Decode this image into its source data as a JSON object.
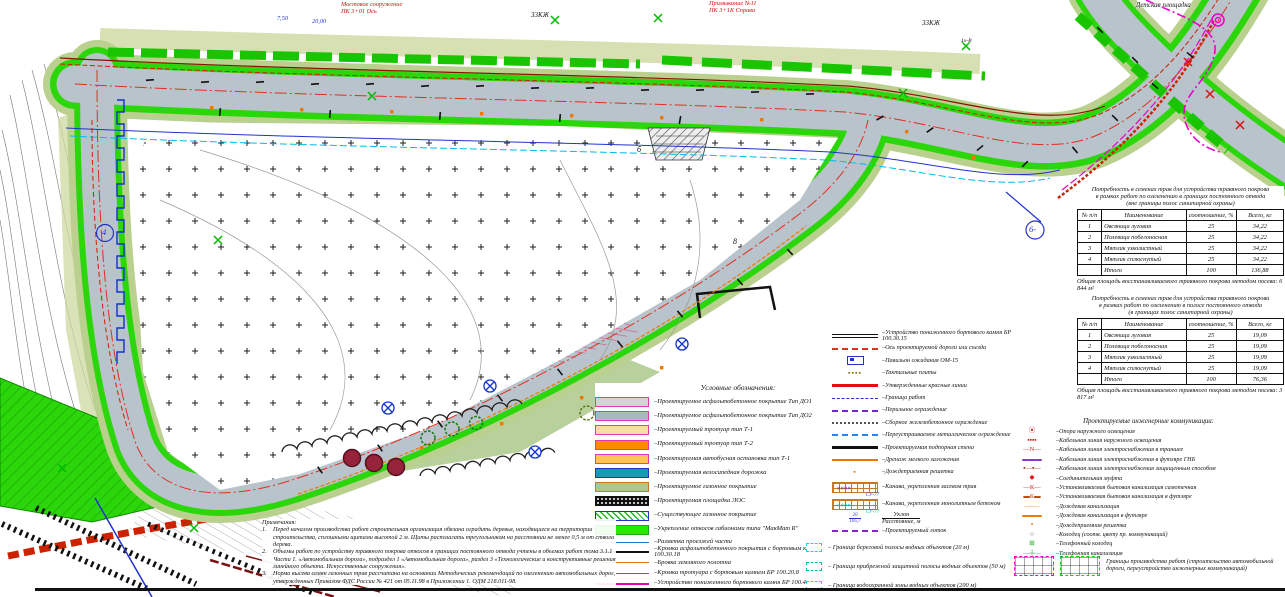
{
  "map": {
    "labels": {
      "bridge_note": [
        "Мостовое сооружение",
        "ПК 3+01 Ось"
      ],
      "junction_note": [
        "Примыкание №11",
        "ПК 3+1К Справа"
      ],
      "building_left": "33КЖ",
      "building_right": "33КЖ",
      "playground": "Детская площадка",
      "tree_tag": "1х-В",
      "dim_a": "7,50",
      "dim_b": "20,00",
      "point_b": "б",
      "point_8": "8",
      "callout_4": "4",
      "callout_6": "6-"
    }
  },
  "legend": {
    "title": "Условные обозначения:",
    "surfaces": [
      {
        "label": "Проектируемое асфальтобетонное покрытие Тип ДО1",
        "fill": "#cdd5da",
        "border": "#e637b8"
      },
      {
        "label": "Проектируемое асфальтобетонное покрытие Тип ДО2",
        "fill": "#a9b9c1",
        "border": "#e637b8"
      },
      {
        "label": "Проектируемый тротуар тип Т-1",
        "fill": "#f9dca6",
        "border": "#e637b8"
      },
      {
        "label": "Проектируемый тротуар тип Т-2",
        "fill": "#ff8a00",
        "border": "#e637b8"
      },
      {
        "label": "Проектируемая автобусная остановка тип Т-1",
        "fill": "#ffc84c",
        "border": "#e637b8"
      },
      {
        "label": "Проектируемая велосипедная дорожка",
        "fill": "#1899b4",
        "border": "#2233cc"
      },
      {
        "label": "Проектируемое газонное покрытие",
        "fill": "#abc98b",
        "border": "#c87820"
      },
      {
        "label": "Проектируемая площадка ЛОС",
        "fill": "#111111",
        "border": "#111111",
        "pattern": "dots"
      },
      {
        "label": "Существующее газонное покрытие",
        "fill": "#ffffff",
        "border": "#2233cc",
        "pattern": "hatch"
      },
      {
        "label": "Укрепление откосов габионами типа \"МакМат R\"",
        "fill": "#2ae800",
        "border": "#18a818"
      }
    ],
    "lines": [
      {
        "label": "Разметка проезжей части",
        "color": "#2277cc",
        "style": "solid",
        "weight": 1
      },
      {
        "label": "Кромка асфальтобетонного покрытия с бортовым камнем БР 100.30.18",
        "color": "#111111",
        "style": "solid",
        "weight": 2
      },
      {
        "label": "Бровка земляного полотна",
        "color": "#ee7700",
        "style": "solid",
        "weight": 1
      },
      {
        "label": "Кромка тротуара с бортовым камнем БР 100.20.8",
        "color": "#cc22cc",
        "style": "solid",
        "weight": 1
      },
      {
        "label": "Устройство пониженного бортового камня БР 100.45.18",
        "color": "#ee00aa",
        "style": "solid",
        "weight": 2
      }
    ],
    "col2": [
      {
        "sym": "double",
        "label": "Устройство пониженного бортового камня БР 100.30.15"
      },
      {
        "sym": "line",
        "color": "#e03020",
        "style": "dashed",
        "weight": 2,
        "label": "Ось проектируемой дороги или съезда"
      },
      {
        "sym": "pavilion",
        "label": "Павильон ожидания ОМ-15"
      },
      {
        "sym": "tactile",
        "glyph": "▪▪▪▪",
        "color": "#8a7a00",
        "label": "Тактильные плиты"
      },
      {
        "sym": "line",
        "color": "#dd1111",
        "style": "solid",
        "weight": 3,
        "label": "Утвержденные красные линии"
      },
      {
        "sym": "line",
        "color": "#2233cc",
        "style": "dashed",
        "weight": 1,
        "label": "Граница работ"
      },
      {
        "sym": "line",
        "color": "#7722cc",
        "style": "dashed",
        "weight": 2,
        "label": "Перильное ограждение"
      },
      {
        "sym": "line",
        "color": "#555555",
        "style": "dotted",
        "weight": 2,
        "label": "Сборное железобетонное ограждение"
      },
      {
        "sym": "line",
        "color": "#2288ee",
        "style": "dashed",
        "weight": 2,
        "label": "Переустраиваемое металлическое ограждение"
      },
      {
        "sym": "line",
        "color": "#111111",
        "style": "solid",
        "weight": 3,
        "label": "Проектируемая подпорная стена"
      },
      {
        "sym": "line",
        "color": "#ee7700",
        "style": "solid",
        "weight": 2,
        "label": "Дренаж мелкого заложения"
      },
      {
        "sym": "grate",
        "glyph": "▪",
        "color": "#ee7700",
        "label": "Дождеприемная решетка"
      },
      {
        "sym": "ditch",
        "accent": "#2233cc",
        "tag": "СУ-77",
        "arrows": "»»»», ",
        "label": "Канава, укрепленная засевом трав"
      },
      {
        "sym": "ditch",
        "accent": "#00b8a8",
        "tag": "СУ-77",
        "arrows": "»»»», ",
        "label": "Канава, укрепленная монолитным бетоном"
      },
      {
        "sym": "slope",
        "top": "20",
        "bottom": "105,7",
        "label_top": "Уклон",
        "label_bottom": "Расстояние, м"
      },
      {
        "sym": "line",
        "color": "#8822cc",
        "style": "dashed",
        "weight": 2,
        "label": "Проектируемый лоток"
      }
    ],
    "water": [
      {
        "color": "#22ccee",
        "label": "Граница береговой полосы водных объектов (20 м)"
      },
      {
        "color": "#00c0a0",
        "label": "Граница прибрежной защитной полосы водных объектов (50 м)"
      },
      {
        "color": "#22ccee",
        "label": "Граница водоохранной зоны водных объектов (200 м)"
      }
    ],
    "comms": {
      "title": "Проектируемые инженерные коммуникации:",
      "items": [
        {
          "glyph": "⦿",
          "color": "#dd1111",
          "label": "Опора наружного освещения"
        },
        {
          "glyph": "▪▪▪▪",
          "color": "#dd1111",
          "label": "Кабельная линия наружного освещения"
        },
        {
          "glyph": "—N—",
          "color": "#dd1111",
          "label": "Кабельная линия электроснабжения в траншее"
        },
        {
          "glyph": "▬▬▬",
          "color": "#8833cc",
          "label": "Кабельная линия электроснабжения в футляре ГНБ"
        },
        {
          "glyph": "▪—▪—",
          "color": "#992200",
          "label": "Кабельная линия электроснабжения защищенным способом"
        },
        {
          "glyph": "◆",
          "color": "#dd1111",
          "label": "Соединительная муфта"
        },
        {
          "glyph": "—К—",
          "color": "#dd1111",
          "label": "Устанавливаемая бытовая канализация самотечная"
        },
        {
          "glyph": "▬К▬",
          "color": "#cc4400",
          "label": "Устанавливаемая бытовая канализация в футляре"
        },
        {
          "glyph": "—◦—",
          "color": "#ee7700",
          "label": "Дождевая канализация"
        },
        {
          "glyph": "▬▬▬",
          "color": "#ee7700",
          "label": "Дождевая канализация в футляре"
        },
        {
          "glyph": "▪",
          "color": "#ee7700",
          "label": "Дождеприемная решетка"
        },
        {
          "glyph": "○",
          "color": "#111111",
          "label": "Колодец (соотв. цвету пр. коммуникаций)"
        },
        {
          "glyph": "⊞",
          "color": "#11aa11",
          "label": "Телефонный колодец"
        },
        {
          "glyph": "—┼—",
          "color": "#11aa11",
          "label": "Телефонная канализация"
        }
      ]
    },
    "boundary": {
      "label": "Границы производства работ (строительство автомобильной дороги, переустройство инженерных коммуникаций)",
      "colors": [
        "#ee00cc",
        "#11cc11"
      ]
    }
  },
  "tables": [
    {
      "title": [
        "Потребность в семенах трав для устройства травяного покрова",
        "в рамках работ по озеленению в границах постоянного отвода",
        "(вне границы полос санитарной охраны)"
      ],
      "columns": [
        "№ п/п",
        "Наименование",
        "соотношение, %",
        "Всего, кг"
      ],
      "rows": [
        [
          "1",
          "Овсяница луговая",
          "25",
          "34,22"
        ],
        [
          "2",
          "Полевица побегоносная",
          "25",
          "34,22"
        ],
        [
          "3",
          "Мятлик узколистный",
          "25",
          "34,22"
        ],
        [
          "4",
          "Мятлик сплюснутый",
          "25",
          "34,22"
        ],
        [
          "",
          "Итого",
          "100",
          "136,88"
        ]
      ],
      "footer": "Общая площадь восстанавливаемого травяного покрова методом посева: 6 844 м²"
    },
    {
      "title": [
        "Потребность в семенах трав для устройства травяного покрова",
        "в рамках работ по озеленению в полосе постоянного отвода",
        "(в границах полос санитарной охраны)"
      ],
      "columns": [
        "№ п/п",
        "Наименование",
        "соотношение, %",
        "Всего, кг"
      ],
      "rows": [
        [
          "1",
          "Овсяница луговая",
          "25",
          "19,09"
        ],
        [
          "2",
          "Полевица побегоносная",
          "25",
          "19,09"
        ],
        [
          "3",
          "Мятлик узколистный",
          "25",
          "19,09"
        ],
        [
          "4",
          "Мятлик сплюснутый",
          "25",
          "19,09"
        ],
        [
          "",
          "Итого",
          "100",
          "76,36"
        ]
      ],
      "footer": "Общая площадь восстанавливаемого травяного покрова методом посева: 3 817 м²"
    }
  ],
  "notes": {
    "heading": "Примечания:",
    "items": [
      "Перед началом производства работ строительная организация обязана оградить деревья, находящиеся на территории строительства, сплошными щитами высотой 2 м. Щиты располагать треугольником на расстоянии не менее 0,5 м от ствола дерева.",
      "Объемы работ по устройству травяного покрова откосов в границах постоянного отвода учтены в объемах работ тома 3.1.1 Части 1. «Автомобильная дорога», подраздел 1 «Автомобильная дорога», раздел 3 «Технологические и конструктивные решения линейного объекта. Искусственные сооружения».",
      "Норма высева семян газонных трав рассчитана на основании Методических рекомендаций по озеленению автомобильных дорог, утвержденных Приказом ФДС России № 421 от 05.11.98 в Приложении 1. ОДМ 218.011-98."
    ]
  }
}
